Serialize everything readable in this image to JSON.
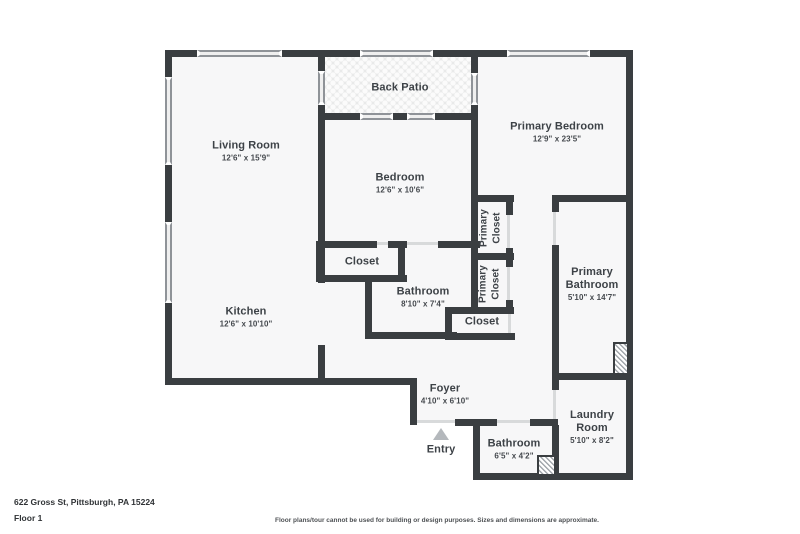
{
  "meta": {
    "address": "622 Gross St, Pittsburgh, PA 15224",
    "floor_label": "Floor 1",
    "disclaimer": "Floor plans/tour cannot be used for building or design purposes. Sizes and dimensions are approximate."
  },
  "colors": {
    "wall": "#3a3e41",
    "room_fill": "#f7f7f8",
    "window": "#efefef",
    "label_text": "#3d4247",
    "entry_arrow": "#b4b8bc"
  },
  "rooms": [
    {
      "name": "Living Room",
      "dims": "12'6\" x 15'9\""
    },
    {
      "name": "Back Patio",
      "dims": ""
    },
    {
      "name": "Primary Bedroom",
      "dims": "12'9\" x 23'5\""
    },
    {
      "name": "Bedroom",
      "dims": "12'6\" x 10'6\""
    },
    {
      "name": "Primary Closet",
      "dims": ""
    },
    {
      "name": "Primary Closet",
      "dims": ""
    },
    {
      "name": "Closet",
      "dims": ""
    },
    {
      "name": "Bathroom",
      "dims": "8'10\" x 7'4\""
    },
    {
      "name": "Closet",
      "dims": ""
    },
    {
      "name": "Primary Bathroom",
      "dims": "5'10\" x 14'7\""
    },
    {
      "name": "Kitchen",
      "dims": "12'6\" x 10'10\""
    },
    {
      "name": "Foyer",
      "dims": "4'10\" x 6'10\""
    },
    {
      "name": "Entry",
      "dims": ""
    },
    {
      "name": "Bathroom",
      "dims": "6'5\" x 4'2\""
    },
    {
      "name": "Laundry Room",
      "dims": "5'10\" x 8'2\""
    }
  ]
}
